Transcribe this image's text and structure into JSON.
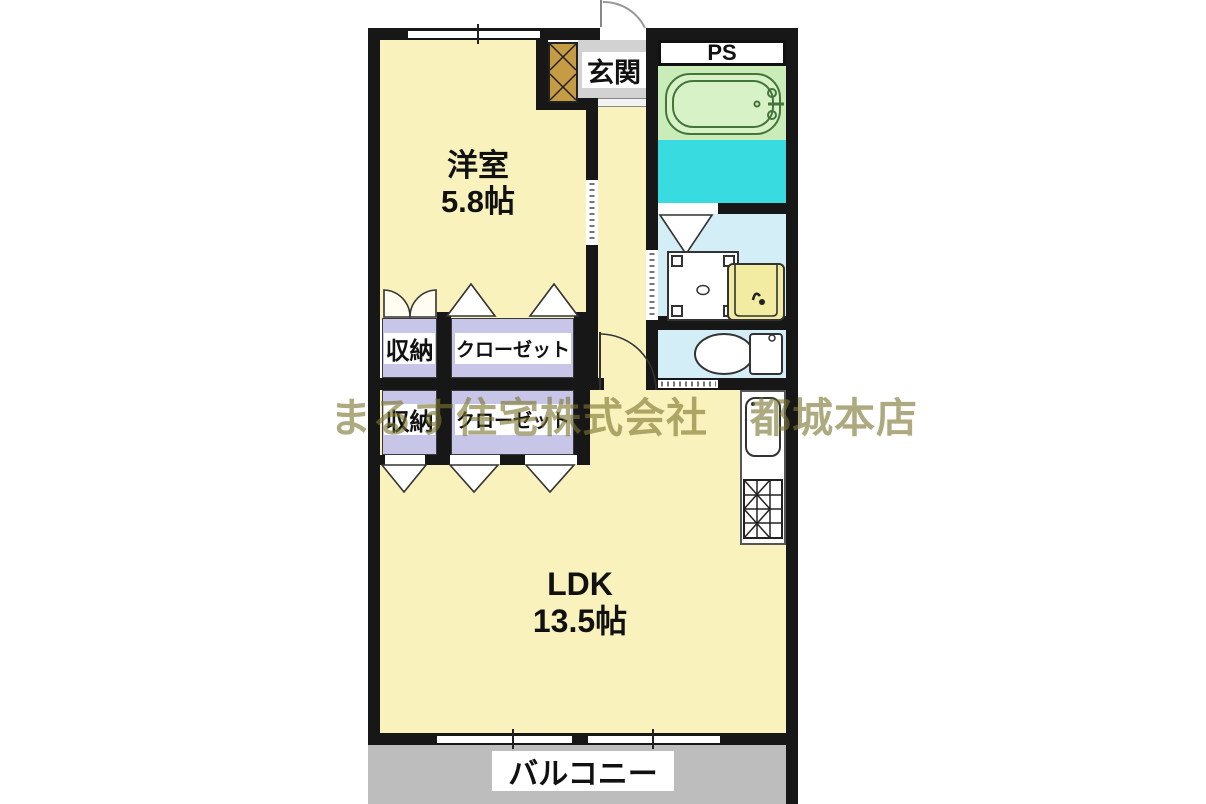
{
  "watermark": "まるす住宅株式会社　都城本店",
  "rooms": {
    "western_room": {
      "name": "洋室",
      "size": "5.8帖"
    },
    "ldk": {
      "name": "LDK",
      "size": "13.5帖"
    },
    "entrance": {
      "label": "玄関"
    },
    "pipe_space": {
      "label": "PS"
    },
    "balcony": {
      "label": "バルコニー"
    },
    "storage_upper": {
      "label": "収納"
    },
    "closet_upper": {
      "label": "クローゼット"
    },
    "storage_lower": {
      "label": "収納"
    },
    "closet_lower": {
      "label": "クローゼット"
    }
  },
  "fixtures": [
    "bathtub",
    "washing-machine-pan",
    "washbasin",
    "toilet",
    "kitchen-sink",
    "gas-stove",
    "shoe-cabinet"
  ],
  "colors": {
    "wall": "#171717",
    "room_floor": "#f9f2bd",
    "bathtub_area": "#c9ecb9",
    "bath_wet_floor": "#38dbe0",
    "washroom_floor": "#d3eef6",
    "storage_floor": "#c7c5e8",
    "entrance_floor": "#d2d2d2",
    "balcony_floor": "#bdbdbd",
    "shoe_cabinet": "#c59b43",
    "basin": "#f1eca2",
    "watermark_text": "#7d7630"
  }
}
